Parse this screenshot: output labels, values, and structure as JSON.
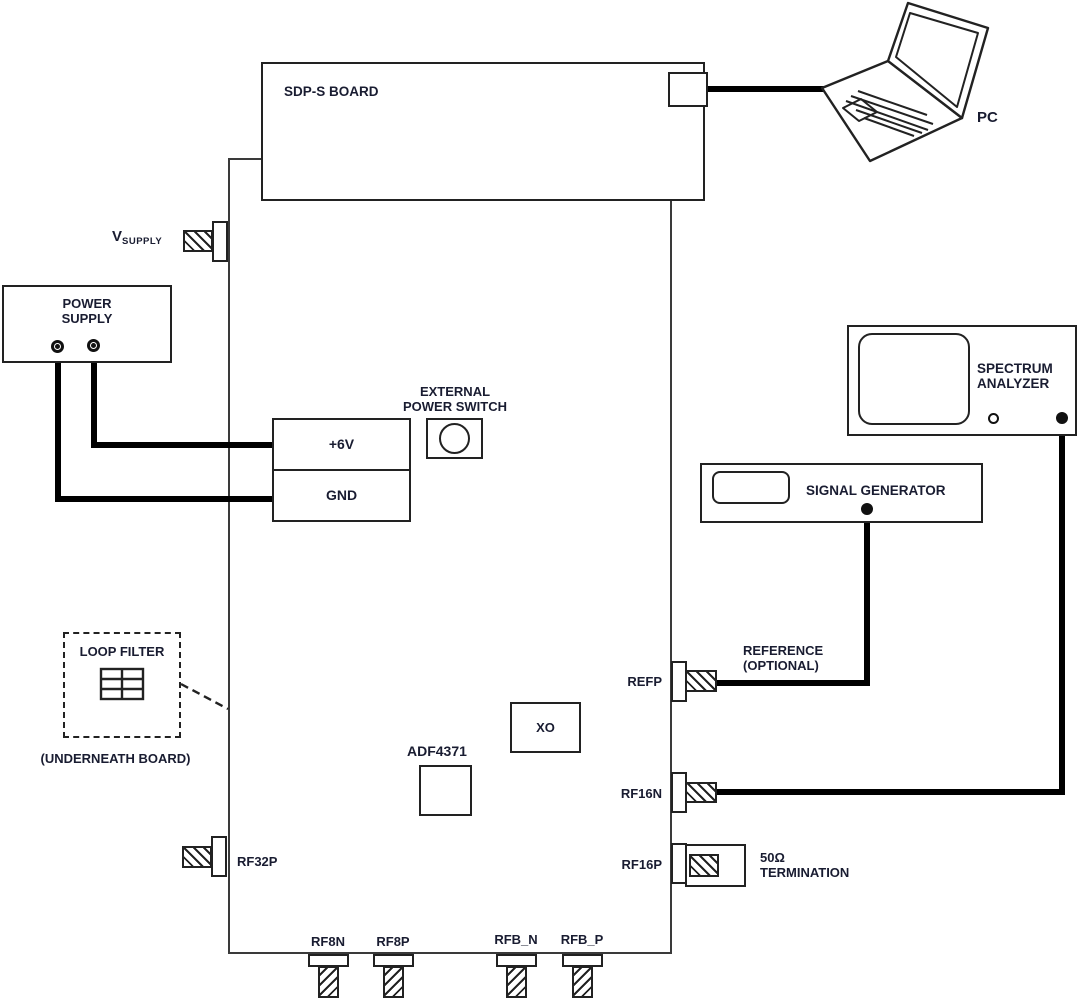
{
  "colors": {
    "background": "#ffffff",
    "line": "#222222",
    "cable": "#000000",
    "text": "#191c31"
  },
  "boxes": {
    "sdp_board": {
      "label": "SDP-S BOARD"
    },
    "pc": {
      "label": "PC"
    },
    "power_supply": {
      "line1": "POWER",
      "line2": "SUPPLY"
    },
    "vsupply": {
      "main": "V",
      "sub": "SUPPLY"
    },
    "external_power_switch": {
      "line1": "EXTERNAL",
      "line2": "POWER SWITCH"
    },
    "terminal_6v": {
      "label": "+6V"
    },
    "terminal_gnd": {
      "label": "GND"
    },
    "loop_filter": {
      "label": "LOOP FILTER",
      "note": "(UNDERNEATH BOARD)"
    },
    "adf4371": {
      "label": "ADF4371"
    },
    "xo": {
      "label": "XO"
    },
    "spectrum_analyzer": {
      "line1": "SPECTRUM",
      "line2": "ANALYZER"
    },
    "signal_generator": {
      "label": "SIGNAL GENERATOR"
    },
    "reference": {
      "line1": "REFERENCE",
      "line2": "(OPTIONAL)"
    },
    "termination": {
      "line1": "50Ω",
      "line2": "TERMINATION"
    }
  },
  "connectors": {
    "refp": "REFP",
    "rf16n": "RF16N",
    "rf16p": "RF16P",
    "rf32p": "RF32P",
    "rf8n": "RF8N",
    "rf8p": "RF8P",
    "rfb_n": "RFB_N",
    "rfb_p": "RFB_P"
  }
}
